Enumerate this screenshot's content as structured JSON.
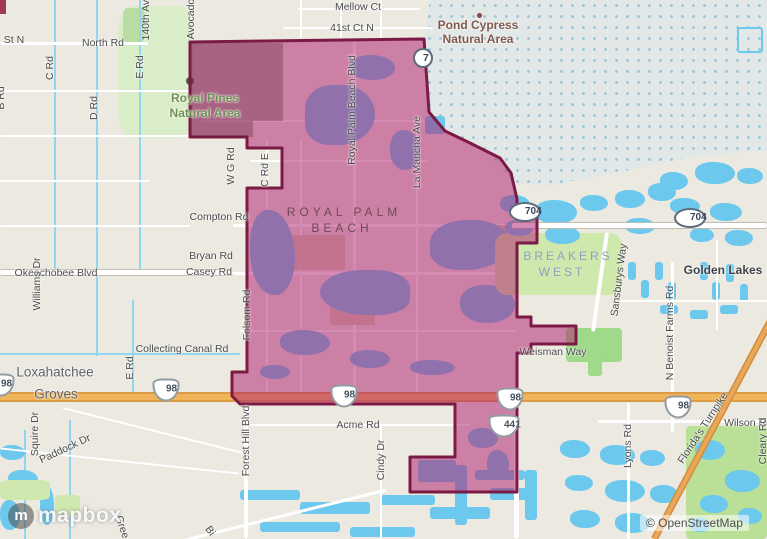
{
  "map_title": "Royal Palm Beach municipal boundary map",
  "labels": {
    "mellow_ct": "Mellow Ct",
    "ct41": "41st Ct N",
    "pond_cypress_1": "Pond Cypress",
    "pond_cypress_2": "Natural Area",
    "st_n": "St N",
    "north_rd": "North Rd",
    "ave140": "140th Ave N",
    "avocado": "Avocado",
    "b_rd": "B Rd",
    "c_rd": "C Rd",
    "d_rd": "D Rd",
    "e_rd_n": "E Rd",
    "royal_pines_1": "Royal Pines",
    "royal_pines_2": "Natural Area",
    "rpb_blvd": "Royal Palm Beach Blvd",
    "la_mancha": "La Mancha Ave",
    "wg_rd": "W G Rd",
    "compton_rd": "Compton Rd",
    "city_1": "ROYAL PALM",
    "city_2": "BEACH",
    "c_rd_e": "C Rd E",
    "okeechobee": "Okeechobee Blvd",
    "williams_dr": "Williams Dr",
    "bryan_rd": "Bryan Rd",
    "casey_rd": "Casey Rd",
    "breakers_1": "BREAKERS",
    "breakers_2": "WEST",
    "sansburys": "Sansburys Way",
    "golden_lakes": "Golden Lakes",
    "collecting": "Collecting Canal Rd",
    "lox_1": "Loxahatchee",
    "lox_2": "Groves",
    "e_rd_s": "E Rd",
    "folsom": "Folsom Rd",
    "weisman": "Weisman Way",
    "forest_hill": "Forest Hill Blvd",
    "acme": "Acme Rd",
    "cindy": "Cindy Dr",
    "squire": "Squire Dr",
    "paddock": "Paddock Dr",
    "gree": "Gree",
    "bi": "Bi",
    "wilson": "Wilson Rd",
    "turnpike": "Florida's Turnpike",
    "benoist": "N Benoist Farms Rd",
    "lyons": "Lyons Rd",
    "cleary": "Cleary Rd"
  },
  "shields": {
    "sr7": "7",
    "cr704": "704",
    "us98": "98",
    "us441": "441"
  },
  "branding": {
    "mapbox": "mapbox",
    "attribution": "© OpenStreetMap"
  },
  "colors": {
    "boundary_stroke": "#7b1b45",
    "boundary_fill": "rgba(177,32,112,0.52)",
    "water": "#6dc8ee",
    "highway_orange": "#f0b55a",
    "park_green": "#cde9ad",
    "land": "#ece9e1"
  }
}
